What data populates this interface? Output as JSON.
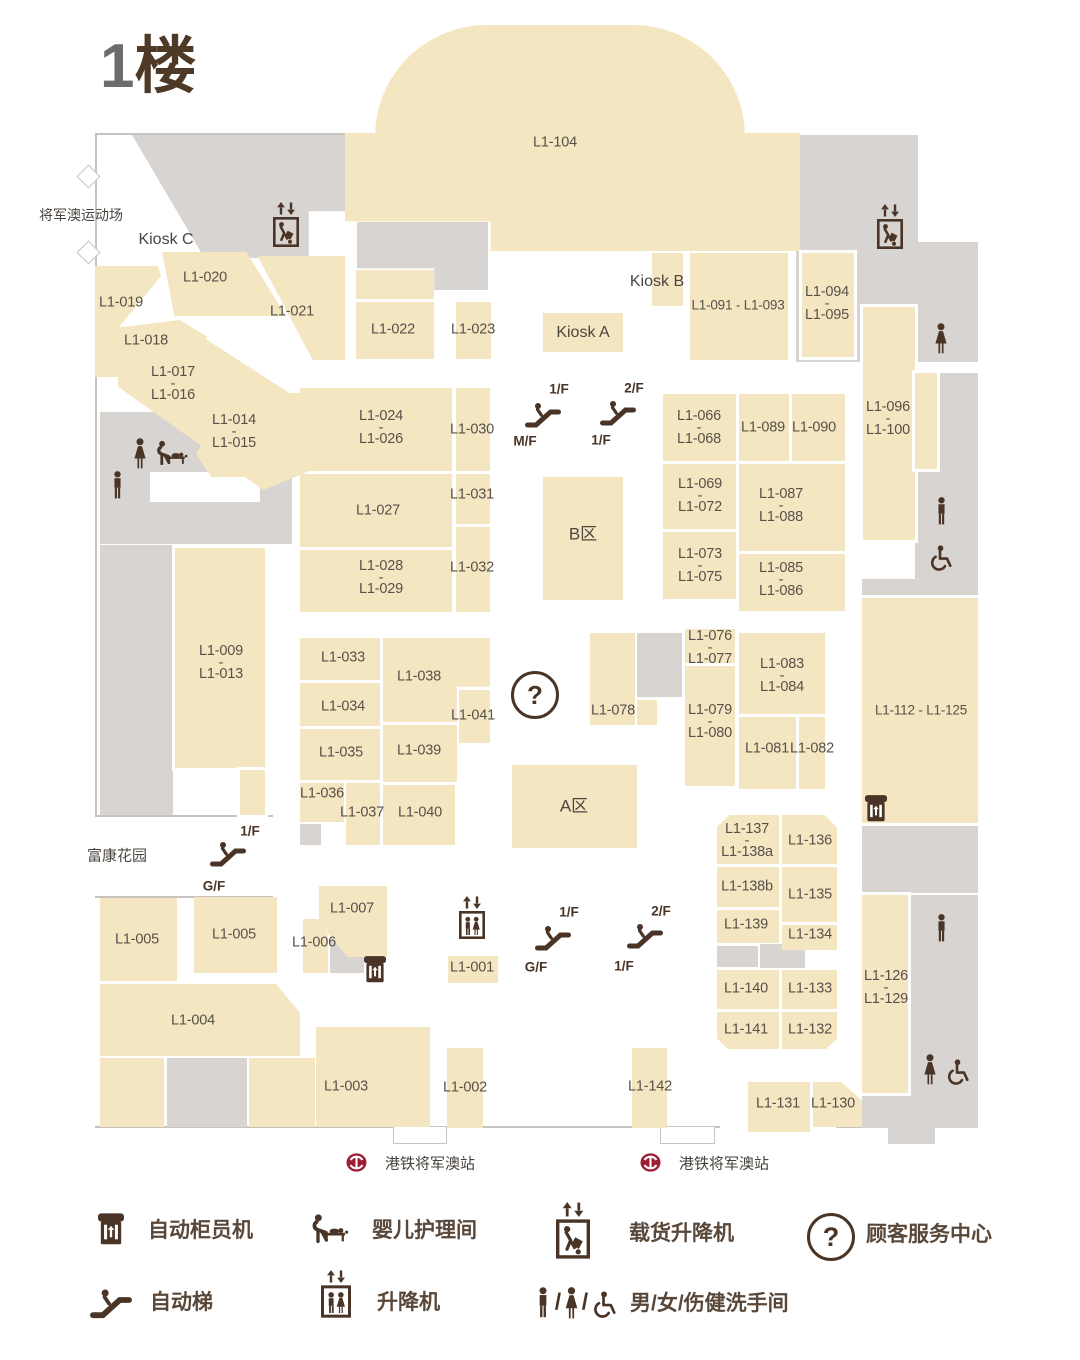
{
  "header": {
    "floor_number": "1",
    "floor_word": "楼"
  },
  "colors": {
    "unit_fill": "#f5e6c2",
    "corridor_fill": "#d7d4d1",
    "ink": "#4a3426",
    "mtr_red": "#9d1d32",
    "title_gray": "#6a6c6e"
  },
  "exits": {
    "sports_ground": "将军澳运动场",
    "fu_kang_garden": "富康花园"
  },
  "mtr": {
    "station_label": "港铁将军澳站"
  },
  "zones": {
    "a": "A区",
    "b": "B区",
    "kiosk_a": "Kiosk A",
    "kiosk_b": "Kiosk B",
    "kiosk_c": "Kiosk C"
  },
  "icons": {
    "question_mark": "?",
    "slash": "/"
  },
  "units": {
    "u104": "L1-104",
    "u020": "L1-020",
    "u019": "L1-019",
    "u018": "L1-018",
    "u017_016": "L1-017\n-\nL1-016",
    "u014_015": "L1-014\n-\nL1-015",
    "u021": "L1-021",
    "u022": "L1-022",
    "u023": "L1-023",
    "u091_093": "L1-091 - L1-093",
    "u094_095": "L1-094\n-\nL1-095",
    "u096_100": "L1-096\n-\nL1-100",
    "u024_026": "L1-024\n-\nL1-026",
    "u030": "L1-030",
    "u027": "L1-027",
    "u031": "L1-031",
    "u028_029": "L1-028\n-\nL1-029",
    "u032": "L1-032",
    "u066_068": "L1-066\n-\nL1-068",
    "u089": "L1-089",
    "u090": "L1-090",
    "u069_072": "L1-069\n-\nL1-072",
    "u087_088": "L1-087\n-\nL1-088",
    "u073_075": "L1-073\n-\nL1-075",
    "u085_086": "L1-085\n-\nL1-086",
    "u009_013": "L1-009\n-\nL1-013",
    "u033": "L1-033",
    "u034": "L1-034",
    "u035": "L1-035",
    "u036": "L1-036",
    "u037": "L1-037",
    "u038": "L1-038",
    "u039": "L1-039",
    "u040": "L1-040",
    "u041": "L1-041",
    "u078": "L1-078",
    "u076_077": "L1-076\n-\nL1-077",
    "u079_080": "L1-079\n-\nL1-080",
    "u083_084": "L1-083\n-\nL1-084",
    "u081": "L1-081",
    "u082": "L1-082",
    "u112_125": "L1-112 - L1-125",
    "u126_129": "L1-126\n-\nL1-129",
    "u137_138a": "L1-137\n-\nL1-138a",
    "u136": "L1-136",
    "u138b": "L1-138b",
    "u135": "L1-135",
    "u139": "L1-139",
    "u134": "L1-134",
    "u140": "L1-140",
    "u133": "L1-133",
    "u141": "L1-141",
    "u132": "L1-132",
    "u131": "L1-131",
    "u130": "L1-130",
    "u001": "L1-001",
    "u002": "L1-002",
    "u003": "L1-003",
    "u004": "L1-004",
    "u005a": "L1-005",
    "u005b": "L1-005",
    "u006": "L1-006",
    "u007": "L1-007",
    "u142": "L1-142"
  },
  "escalators": {
    "center_lower": {
      "up": "1/F",
      "down": "M/F"
    },
    "center_upper": {
      "up": "2/F",
      "down": "1/F"
    },
    "southwest": {
      "up": "1/F",
      "down": "G/F"
    },
    "south_lower": {
      "up": "1/F",
      "down": "G/F"
    },
    "south_upper": {
      "up": "2/F",
      "down": "1/F"
    }
  },
  "legend": [
    {
      "icon": "atm-icon",
      "label": "自动柜员机"
    },
    {
      "icon": "baby-care-icon",
      "label": "婴儿护理间"
    },
    {
      "icon": "cargo-lift-icon",
      "label": "载货升降机"
    },
    {
      "icon": "info-icon",
      "label": "顾客服务中心"
    },
    {
      "icon": "escalator-icon",
      "label": "自动梯"
    },
    {
      "icon": "lift-icon",
      "label": "升降机"
    },
    {
      "icon": "toilets-icon-group",
      "label": "男/女/伤健洗手间"
    }
  ]
}
